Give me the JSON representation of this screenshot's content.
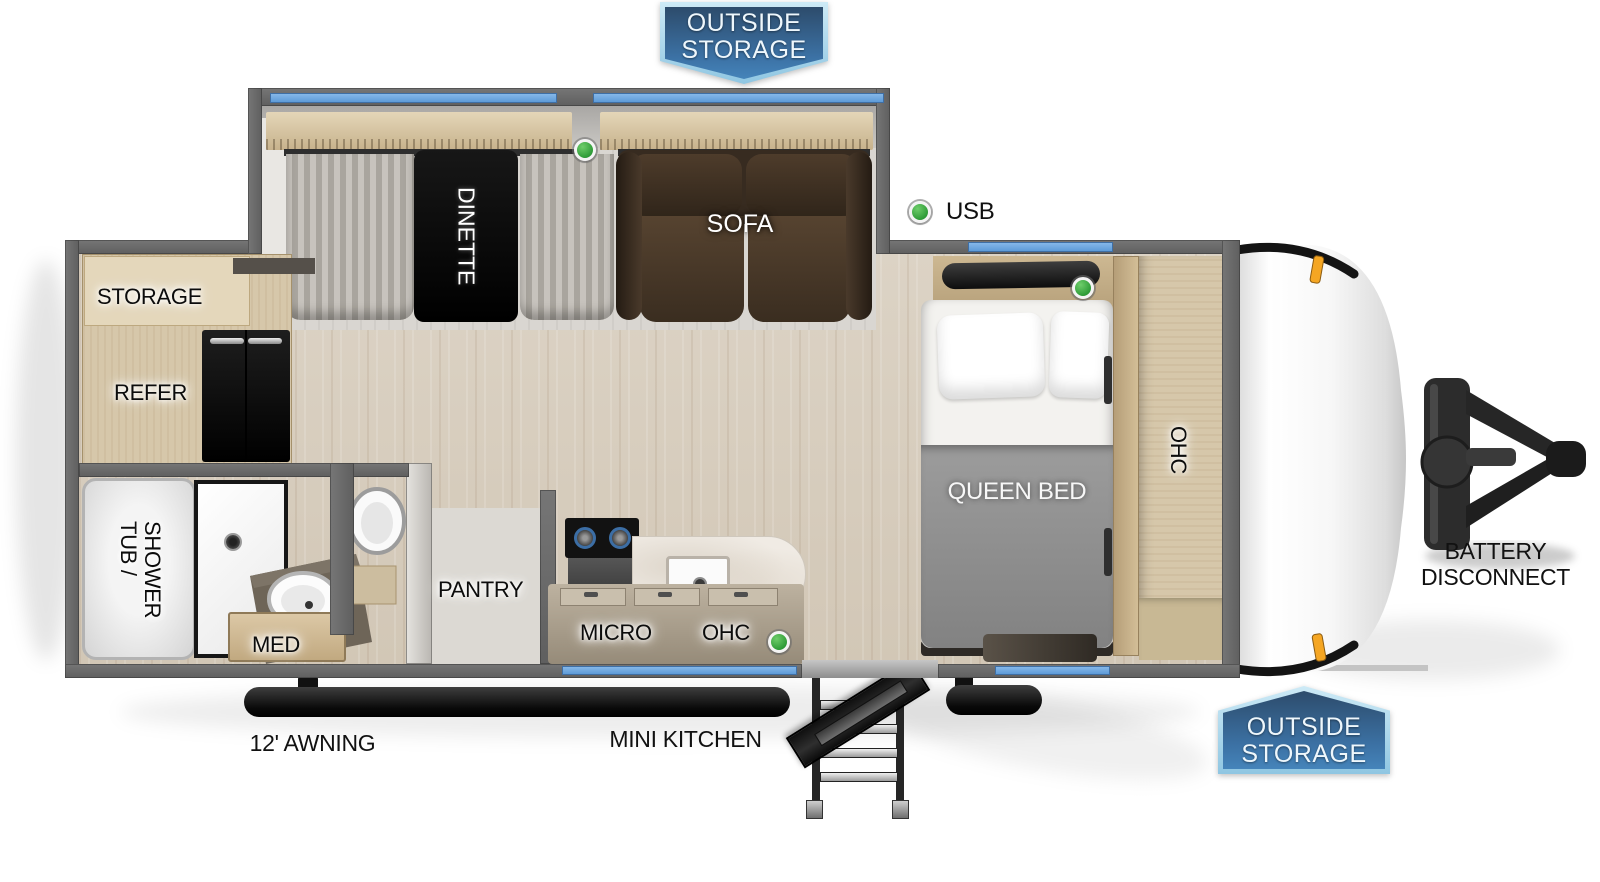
{
  "title": "Travel trailer floor plan",
  "badges": {
    "top": {
      "line1": "OUTSIDE",
      "line2": "STORAGE"
    },
    "bottom": {
      "line1": "OUTSIDE",
      "line2": "STORAGE"
    }
  },
  "legend": {
    "usb_label": "USB"
  },
  "exterior": {
    "awning_label": "12' AWNING",
    "mini_kitchen_label": "MINI KITCHEN",
    "battery_line1": "BATTERY",
    "battery_line2": "DISCONNECT"
  },
  "rooms": {
    "dinette": "DINETTE",
    "sofa": "SOFA",
    "storage": "STORAGE",
    "refer": "REFER",
    "queen_bed": "QUEEN BED",
    "ohc_bedroom": "OHC",
    "tub_shower_line1": "TUB /",
    "tub_shower_line2": "SHOWER",
    "med": "MED",
    "pantry": "PANTRY",
    "micro": "MICRO",
    "ohc_kitchen": "OHC"
  },
  "colors": {
    "window_blue": "#6fa9e1",
    "badge_dark_blue": "#2d4c6c",
    "badge_light_blue": "#4584ba",
    "badge_border_blue": "#a9dcf0",
    "indicator_green": "#3cb043",
    "marker_orange": "#f5a623",
    "wall_gray": "#6b6b6b"
  },
  "indicators": {
    "green_dot_count": 4
  }
}
